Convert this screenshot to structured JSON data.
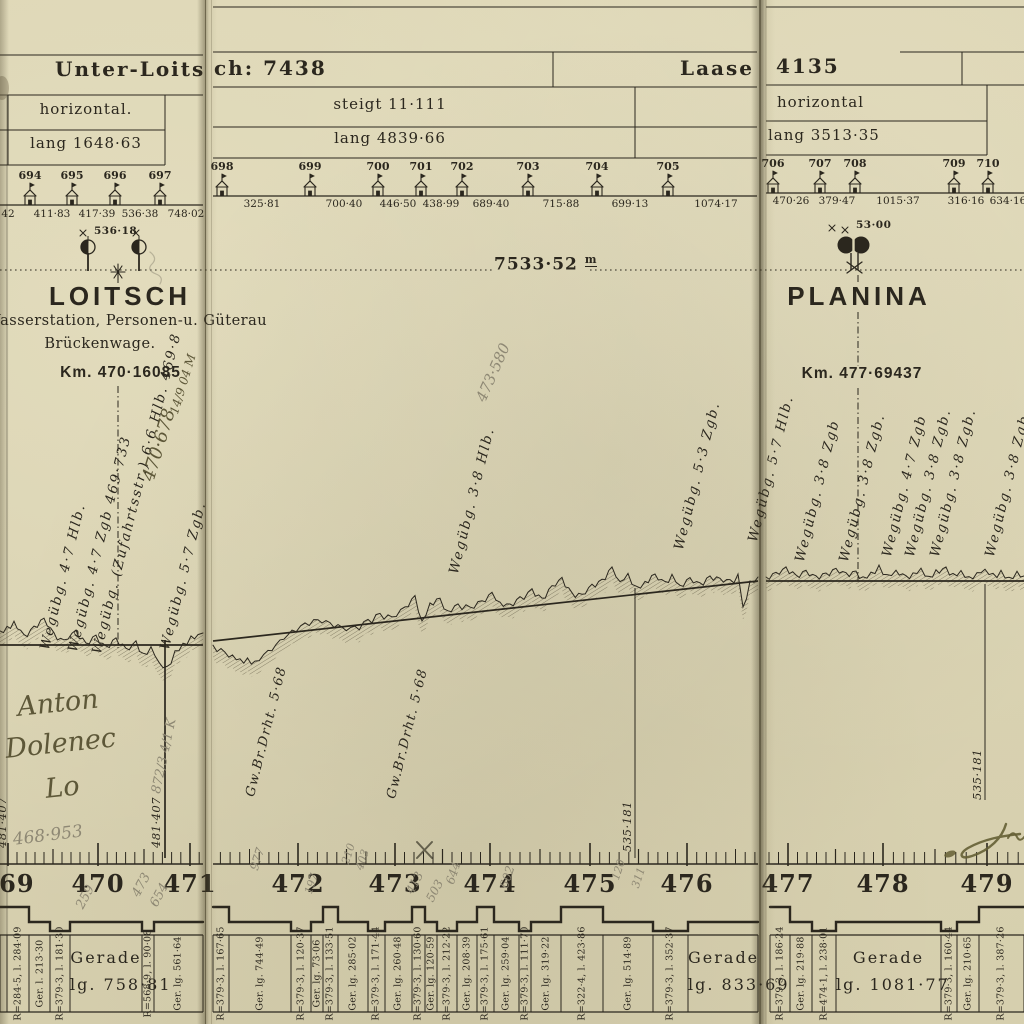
{
  "pages": {
    "left": {
      "title": "Unter-Loits",
      "grade": "horizontal.",
      "length": "lang 1648·63",
      "houses": [
        {
          "n": "694",
          "x": 30
        },
        {
          "n": "695",
          "x": 72
        },
        {
          "n": "696",
          "x": 115
        },
        {
          "n": "697",
          "x": 160
        }
      ],
      "house_distances": [
        {
          "t": "42",
          "x": 8
        },
        {
          "t": "411·83",
          "x": 52
        },
        {
          "t": "417·39",
          "x": 97
        },
        {
          "t": "536·38",
          "x": 140
        },
        {
          "t": "748·02",
          "x": 186
        }
      ]
    },
    "middle": {
      "title": "ch: 7438",
      "next_station_title": "Laase",
      "grade": "steigt 11·111",
      "length": "lang 4839·66",
      "houses": [
        {
          "n": "698",
          "x": 222
        },
        {
          "n": "699",
          "x": 310
        },
        {
          "n": "700",
          "x": 378
        },
        {
          "n": "701",
          "x": 421
        },
        {
          "n": "702",
          "x": 462
        },
        {
          "n": "703",
          "x": 528
        },
        {
          "n": "704",
          "x": 597
        },
        {
          "n": "705",
          "x": 668
        }
      ],
      "house_distances": [
        {
          "t": "325·81",
          "x": 262
        },
        {
          "t": "700·40",
          "x": 344
        },
        {
          "t": "446·50",
          "x": 398
        },
        {
          "t": "438·99",
          "x": 441
        },
        {
          "t": "689·40",
          "x": 491
        },
        {
          "t": "715·88",
          "x": 561
        },
        {
          "t": "699·13",
          "x": 630
        },
        {
          "t": "1074·17",
          "x": 716
        }
      ]
    },
    "right": {
      "title": "4135",
      "grade": "horizontal",
      "length": "lang 3513·35",
      "houses": [
        {
          "n": "706",
          "x": 773
        },
        {
          "n": "707",
          "x": 820
        },
        {
          "n": "708",
          "x": 855
        },
        {
          "n": "709",
          "x": 954
        },
        {
          "n": "710",
          "x": 988
        }
      ],
      "house_distances": [
        {
          "t": "470·26",
          "x": 791
        },
        {
          "t": "379·47",
          "x": 837
        },
        {
          "t": "1015·37",
          "x": 898
        },
        {
          "t": "316·16",
          "x": 966
        },
        {
          "t": "634·16",
          "x": 1008
        }
      ]
    }
  },
  "stations": {
    "loitsch": {
      "name": "LOITSCH",
      "desc1": "Wasserstation, Personen-u. Güterau",
      "desc2": "Brückenwage.",
      "km": "Km. 470·16085",
      "signal_mark": "536·18"
    },
    "planina": {
      "name": "PLANINA",
      "km": "Km. 477·69437",
      "signal_mark": "53·00"
    }
  },
  "section_length": {
    "value": "7533·52",
    "unit": "m"
  },
  "level_crossings": {
    "left": [
      {
        "t": "Wegübg. 4·7 Hlb.",
        "x": 38,
        "y": 648
      },
      {
        "t": "Wegübg. 4·7 Zgb 469·733",
        "x": 66,
        "y": 650
      },
      {
        "t": "Wegübg. (Zufahrtsstr.) 6·6 Hlb. 469·8",
        "x": 90,
        "y": 652
      },
      {
        "t": "Wegübg. 5·7 Zgb.",
        "x": 158,
        "y": 648
      }
    ],
    "middle": [
      {
        "t": "Wegübg. 3·8 Hlb.",
        "x": 447,
        "y": 572
      },
      {
        "t": "Wegübg. 5·3 Zgb.",
        "x": 672,
        "y": 548
      },
      {
        "t": "Wegübg. 5·7 Hlb.",
        "x": 746,
        "y": 540
      }
    ],
    "right": [
      {
        "t": "Wegübg. 3·8 Zgb",
        "x": 793,
        "y": 560
      },
      {
        "t": "Wegübg. 3·8 Zgb.",
        "x": 837,
        "y": 560
      },
      {
        "t": "Wegübg. 4·7 Zgb",
        "x": 880,
        "y": 555
      },
      {
        "t": "Wegübg. 3·8 Zgb.",
        "x": 903,
        "y": 555
      },
      {
        "t": "Wegübg. 3·8 Zgb.",
        "x": 928,
        "y": 555
      },
      {
        "t": "Wegübg. 3·8 Zgb.",
        "x": 983,
        "y": 555
      }
    ]
  },
  "bridges": [
    {
      "t": "Gw.Br.Drht. 5·68",
      "x": 244,
      "y": 795
    },
    {
      "t": "Gw.Br.Drht. 5·68",
      "x": 385,
      "y": 797
    }
  ],
  "chainage_marks": [
    {
      "t": "481·407",
      "x": -4,
      "y": 848
    },
    {
      "t": "481·407",
      "x": 150,
      "y": 848
    },
    {
      "t": "535·181",
      "x": 621,
      "y": 852
    },
    {
      "t": "535·181",
      "x": 971,
      "y": 800
    }
  ],
  "ruler": {
    "km_labels": [
      {
        "t": "469",
        "x": 8
      },
      {
        "t": "470",
        "x": 98
      },
      {
        "t": "471",
        "x": 190
      },
      {
        "t": "472",
        "x": 298
      },
      {
        "t": "473",
        "x": 395
      },
      {
        "t": "474",
        "x": 490
      },
      {
        "t": "475",
        "x": 590
      },
      {
        "t": "476",
        "x": 687
      },
      {
        "t": "477",
        "x": 788
      },
      {
        "t": "478",
        "x": 883
      },
      {
        "t": "479",
        "x": 987
      }
    ]
  },
  "curve_table": {
    "left": [
      {
        "t": "",
        "w": 7,
        "band": "up"
      },
      {
        "t": "R=284·5, l. 284·09",
        "w": 22,
        "band": "up"
      },
      {
        "t": "Ger. l. 213·30",
        "w": 21,
        "band": "flat"
      },
      {
        "t": "R=379·3, l. 181·30",
        "w": 20,
        "band": "down"
      },
      {
        "t": "Gerade|lg. 758·81",
        "w": 72,
        "band": "flat",
        "wide": true
      },
      {
        "t": "R=568·9, l. 90·08",
        "w": 12,
        "band": "down"
      },
      {
        "t": "Ger. lg. 561·64",
        "w": 49,
        "band": "flat"
      }
    ],
    "middle": [
      {
        "t": "R=379·3, l. 167·65",
        "w": 16,
        "band": "up"
      },
      {
        "t": "Ger. lg. 744·49",
        "w": 62,
        "band": "flat"
      },
      {
        "t": "R=379·3, l. 120·37",
        "w": 20,
        "band": "down"
      },
      {
        "t": "Ger. lg. 73·06",
        "w": 12,
        "band": "flat"
      },
      {
        "t": "R=379·3, l. 133·51",
        "w": 15,
        "band": "up"
      },
      {
        "t": "Ger. lg. 285·02",
        "w": 30,
        "band": "flat"
      },
      {
        "t": "R=379·3, l. 171·44",
        "w": 17,
        "band": "down"
      },
      {
        "t": "Ger. lg. 260·48",
        "w": 27,
        "band": "flat"
      },
      {
        "t": "R=379·3, l. 130·60",
        "w": 13,
        "band": "up"
      },
      {
        "t": "Ger. lg. 120·59",
        "w": 12,
        "band": "flat"
      },
      {
        "t": "R=379·3, l. 212·22",
        "w": 20,
        "band": "down"
      },
      {
        "t": "Ger. lg. 208·39",
        "w": 20,
        "band": "flat"
      },
      {
        "t": "R=379·3, l. 175·61",
        "w": 17,
        "band": "up"
      },
      {
        "t": "Ger. lg. 259·04",
        "w": 25,
        "band": "flat"
      },
      {
        "t": "R=379·3, l. 111·70",
        "w": 12,
        "band": "down"
      },
      {
        "t": "Ger. lg. 319·22",
        "w": 30,
        "band": "flat"
      },
      {
        "t": "R=322·4, l. 423·86",
        "w": 42,
        "band": "up"
      },
      {
        "t": "Ger. lg. 514·89",
        "w": 50,
        "band": "flat"
      },
      {
        "t": "R=379·3, l. 352·37",
        "w": 35,
        "band": "down"
      },
      {
        "t": "Gerade|lg. 833·69",
        "w": 70,
        "band": "flat",
        "wide": true
      }
    ],
    "right": [
      {
        "t": "R=379·3, l. 186·24",
        "w": 20,
        "band": "up"
      },
      {
        "t": "Ger. lg. 219·88",
        "w": 22,
        "band": "flat"
      },
      {
        "t": "R=474·1, l. 238·01",
        "w": 24,
        "band": "down"
      },
      {
        "t": "Gerade|lg. 1081·77",
        "w": 105,
        "band": "flat",
        "wide": true
      },
      {
        "t": "R=379·3, l. 160·44",
        "w": 16,
        "band": "down"
      },
      {
        "t": "Ger. lg. 210·65",
        "w": 22,
        "band": "flat"
      },
      {
        "t": "R=379·3, l. 387·26",
        "w": 45,
        "band": "up"
      }
    ]
  },
  "handwriting": {
    "ink": [
      {
        "t": "Anton",
        "x": 16,
        "y": 726,
        "rot": -6,
        "size": 27
      },
      {
        "t": "Dolenec",
        "x": 4,
        "y": 768,
        "rot": -6,
        "size": 27
      },
      {
        "t": "Lo",
        "x": 44,
        "y": 808,
        "rot": -6,
        "size": 27
      },
      {
        "t": "470·678",
        "x": 140,
        "y": 478,
        "rot": -73,
        "size": 18
      },
      {
        "t": "14/9 04 M",
        "x": 168,
        "y": 412,
        "rot": -73,
        "size": 12
      }
    ],
    "pencil": [
      {
        "t": "468·953",
        "x": 12,
        "y": 852,
        "rot": -7,
        "size": 17
      },
      {
        "t": "872/3 4/1 K",
        "x": 150,
        "y": 792,
        "rot": -78,
        "size": 13
      },
      {
        "t": "473·580",
        "x": 474,
        "y": 398,
        "rot": -66,
        "size": 15
      },
      {
        "t": "259",
        "x": 74,
        "y": 905,
        "rot": -62,
        "size": 13
      },
      {
        "t": "473",
        "x": 130,
        "y": 893,
        "rot": -62,
        "size": 13
      },
      {
        "t": "654",
        "x": 148,
        "y": 903,
        "rot": -62,
        "size": 13
      },
      {
        "t": "413",
        "x": 404,
        "y": 890,
        "rot": -62,
        "size": 12
      },
      {
        "t": "503",
        "x": 424,
        "y": 898,
        "rot": -62,
        "size": 12
      },
      {
        "t": "977",
        "x": 248,
        "y": 868,
        "rot": -72,
        "size": 12
      },
      {
        "t": "210",
        "x": 340,
        "y": 862,
        "rot": -72,
        "size": 11
      },
      {
        "t": "403",
        "x": 354,
        "y": 868,
        "rot": -72,
        "size": 11
      },
      {
        "t": "197",
        "x": 303,
        "y": 892,
        "rot": -72,
        "size": 11
      },
      {
        "t": "644",
        "x": 444,
        "y": 882,
        "rot": -72,
        "size": 12
      },
      {
        "t": "602",
        "x": 498,
        "y": 886,
        "rot": -72,
        "size": 12
      },
      {
        "t": "120",
        "x": 610,
        "y": 878,
        "rot": -72,
        "size": 11
      },
      {
        "t": "311",
        "x": 630,
        "y": 886,
        "rot": -72,
        "size": 11
      }
    ]
  },
  "colors": {
    "paper": "#dcd5b4",
    "print_ink": "#2b271e",
    "pencil": "#8e8874",
    "hand_ink": "#5d5738"
  }
}
